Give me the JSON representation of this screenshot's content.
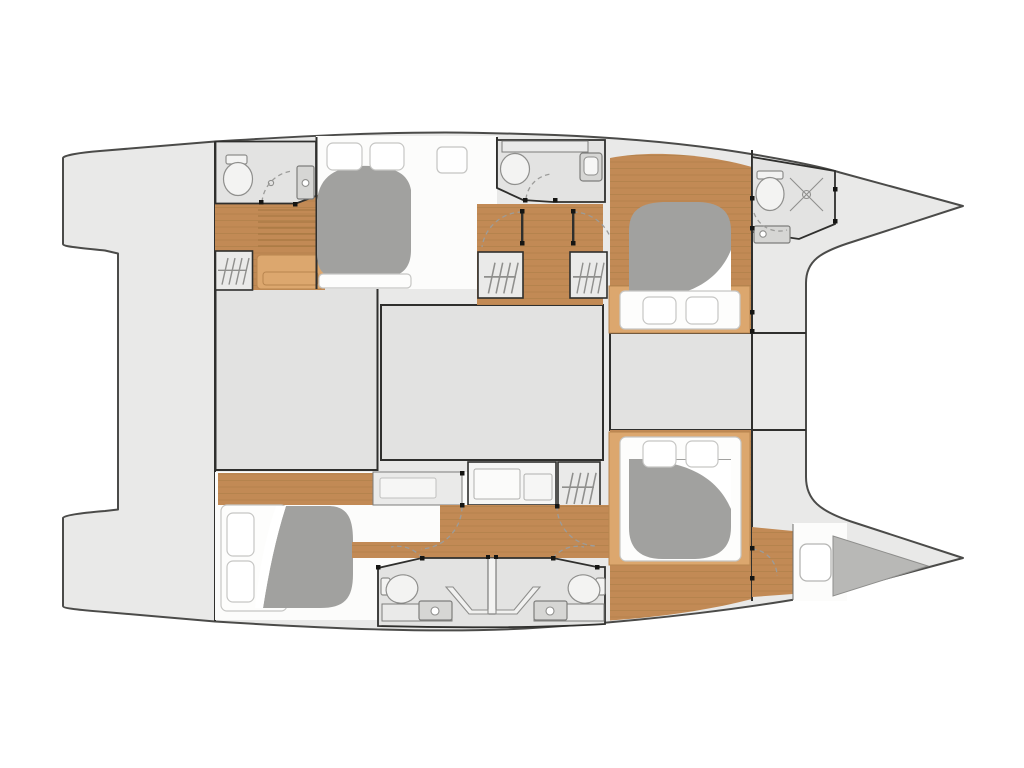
{
  "meta": {
    "title": "catamaran-lower-deck-floor-plan",
    "type": "boat floor plan, top-down view, bows pointing right",
    "visible_text": []
  },
  "colors": {
    "bg": "#ffffff",
    "hull": "#e9e9e8",
    "hullStroke": "#4b4b49",
    "block": "#e2e2e1",
    "bath": "#e3e3e2",
    "cabin": "#fcfcfb",
    "wood": "#c28a55",
    "plank": "#a3763f",
    "woodLight": "#dca76e",
    "duvet": "#a1a19f",
    "forepeak": "#b8b8b6",
    "mattress": "#fdfdfc",
    "mattressStroke": "#c6c6c4",
    "wall": "#2f2f2d",
    "dot": "#151513",
    "dash": "#9c9c9a",
    "hanger": "#8f8f8d",
    "fixture": "#8f8f8d",
    "sink": "#d6d6d4"
  },
  "vessel": {
    "hulls": [
      "port-hull-top",
      "starboard-hull-bottom"
    ],
    "center_structures": [
      "aft-cockpit-deck",
      "saloon-block-left",
      "saloon-block-middle",
      "saloon-block-right",
      "forward-crossbeam-deck"
    ],
    "port_hull_rooms": [
      "aft-bathroom",
      "companionway-stairs",
      "aft-wardrobe",
      "aft-cabin-double-bed",
      "mid-bathroom",
      "corridor-with-doors",
      "two-wardrobes",
      "forward-cabin-island-bed",
      "bow-bathroom-with-shower"
    ],
    "starboard_hull_rooms": [
      "aft-cabin-double-bed",
      "vanity-desk",
      "wardrobe",
      "corridor-with-doors",
      "twin-mid-bathrooms",
      "forward-cabin-island-bed",
      "forepeak-locker"
    ],
    "bed_count": 4,
    "bathroom_count": 5
  }
}
